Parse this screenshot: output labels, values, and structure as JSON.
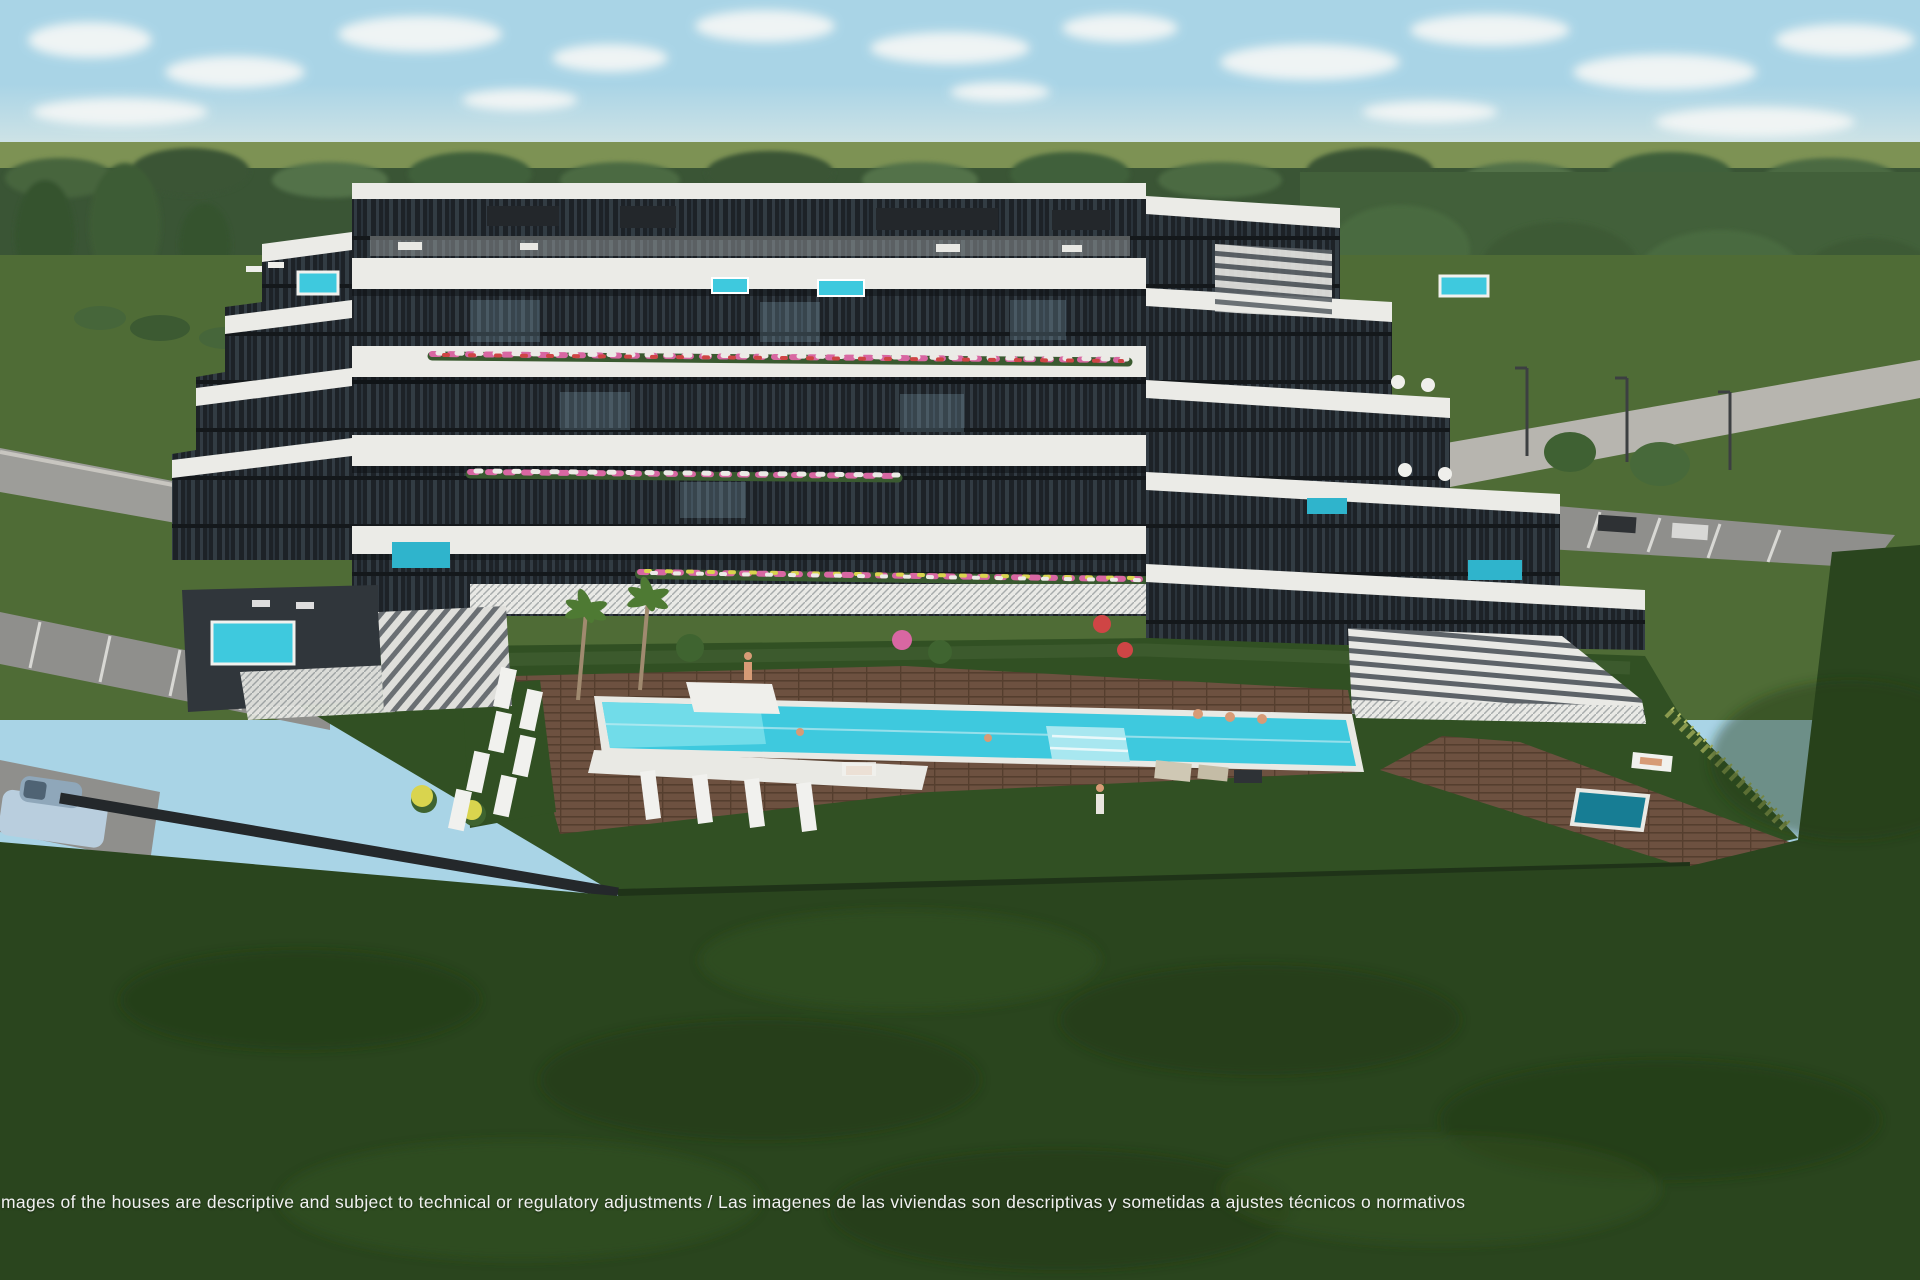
{
  "scene": {
    "disclaimer": "mages of the houses are descriptive and subject to technical or regulatory adjustments / Las imagenes de las viviendas son descriptivas y sometidas a ajustes técnicos o normativos"
  },
  "colors": {
    "sky": "#a9d4e6",
    "horizon_haze": "#e3ebe5",
    "distant_field": "#7d9254",
    "treeline": "#3a5535",
    "midground_lawn": "#4f6c36",
    "garden_lawn": "#315023",
    "foreground_lawn": "#2a451e",
    "road": "#9d9d99",
    "sidewalk": "#b7b5af",
    "parking": "#8f8f8c",
    "building_white": "#ebebe7",
    "building_glass": "#1d2227",
    "pool_water": "#3ec9de",
    "spa_water": "#177d94",
    "wood_deck": "#6d5140",
    "hedge": "#3d5b2e",
    "boundary_wall": "#24282b",
    "lounger_white": "#f1f1ee",
    "car_body": "#b9cede",
    "disclaimer_text": "#f1f1f1"
  }
}
